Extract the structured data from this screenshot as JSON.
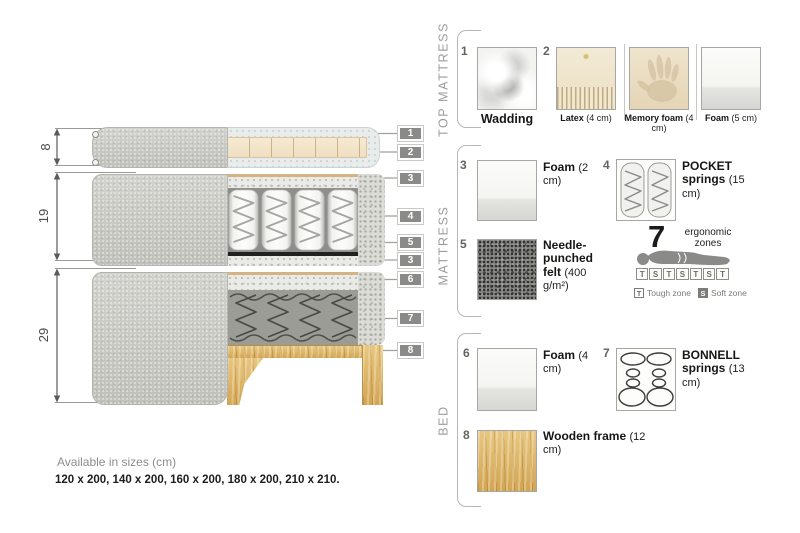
{
  "diagram": {
    "dims": [
      "8",
      "19",
      "29"
    ],
    "tags": [
      "1",
      "2",
      "3",
      "4",
      "5",
      "3",
      "6",
      "7",
      "8"
    ]
  },
  "legend": {
    "top": {
      "label": "TOP MATTRESS",
      "wadding": {
        "num": "1",
        "name": "Wadding"
      },
      "latex": {
        "num": "2",
        "name": "Latex",
        "size": "(4 cm)"
      },
      "memory": {
        "name": "Memory foam",
        "size": "(4 cm)"
      },
      "foam": {
        "name": "Foam",
        "size": "(5 cm)"
      }
    },
    "mattress": {
      "label": "MATTRESS",
      "foam": {
        "num": "3",
        "name": "Foam",
        "size": "(2 cm)"
      },
      "pocket": {
        "num": "4",
        "name": "POCKET springs",
        "size": "(15 cm)"
      },
      "felt": {
        "num": "5",
        "name": "Needle-punched felt",
        "size": "(400 g/m²)"
      },
      "zones": {
        "count": "7",
        "label": "ergonomic zones",
        "boxes": [
          "T",
          "S",
          "T",
          "S",
          "T",
          "S",
          "T"
        ],
        "tough_key": "T",
        "tough_label": "Tough zone",
        "soft_key": "S",
        "soft_label": "Soft zone"
      }
    },
    "bed": {
      "label": "BED",
      "foam": {
        "num": "6",
        "name": "Foam",
        "size": "(4 cm)"
      },
      "bonnell": {
        "num": "7",
        "name": "BONNELL springs",
        "size": "(13 cm)"
      },
      "wood": {
        "num": "8",
        "name": "Wooden frame",
        "size": "(12 cm)"
      }
    }
  },
  "footer": {
    "title": "Available in sizes (cm)",
    "sizes": "120 x 200, 140 x 200, 160 x 200, 180 x 200, 210 x 210."
  },
  "colors": {
    "tag_background": "#8a8a88",
    "fabric_gray": "#c9c9c4",
    "latex_cream": "#f2ead6",
    "wood": "#ddb469",
    "felt_dark": "#21211f"
  }
}
